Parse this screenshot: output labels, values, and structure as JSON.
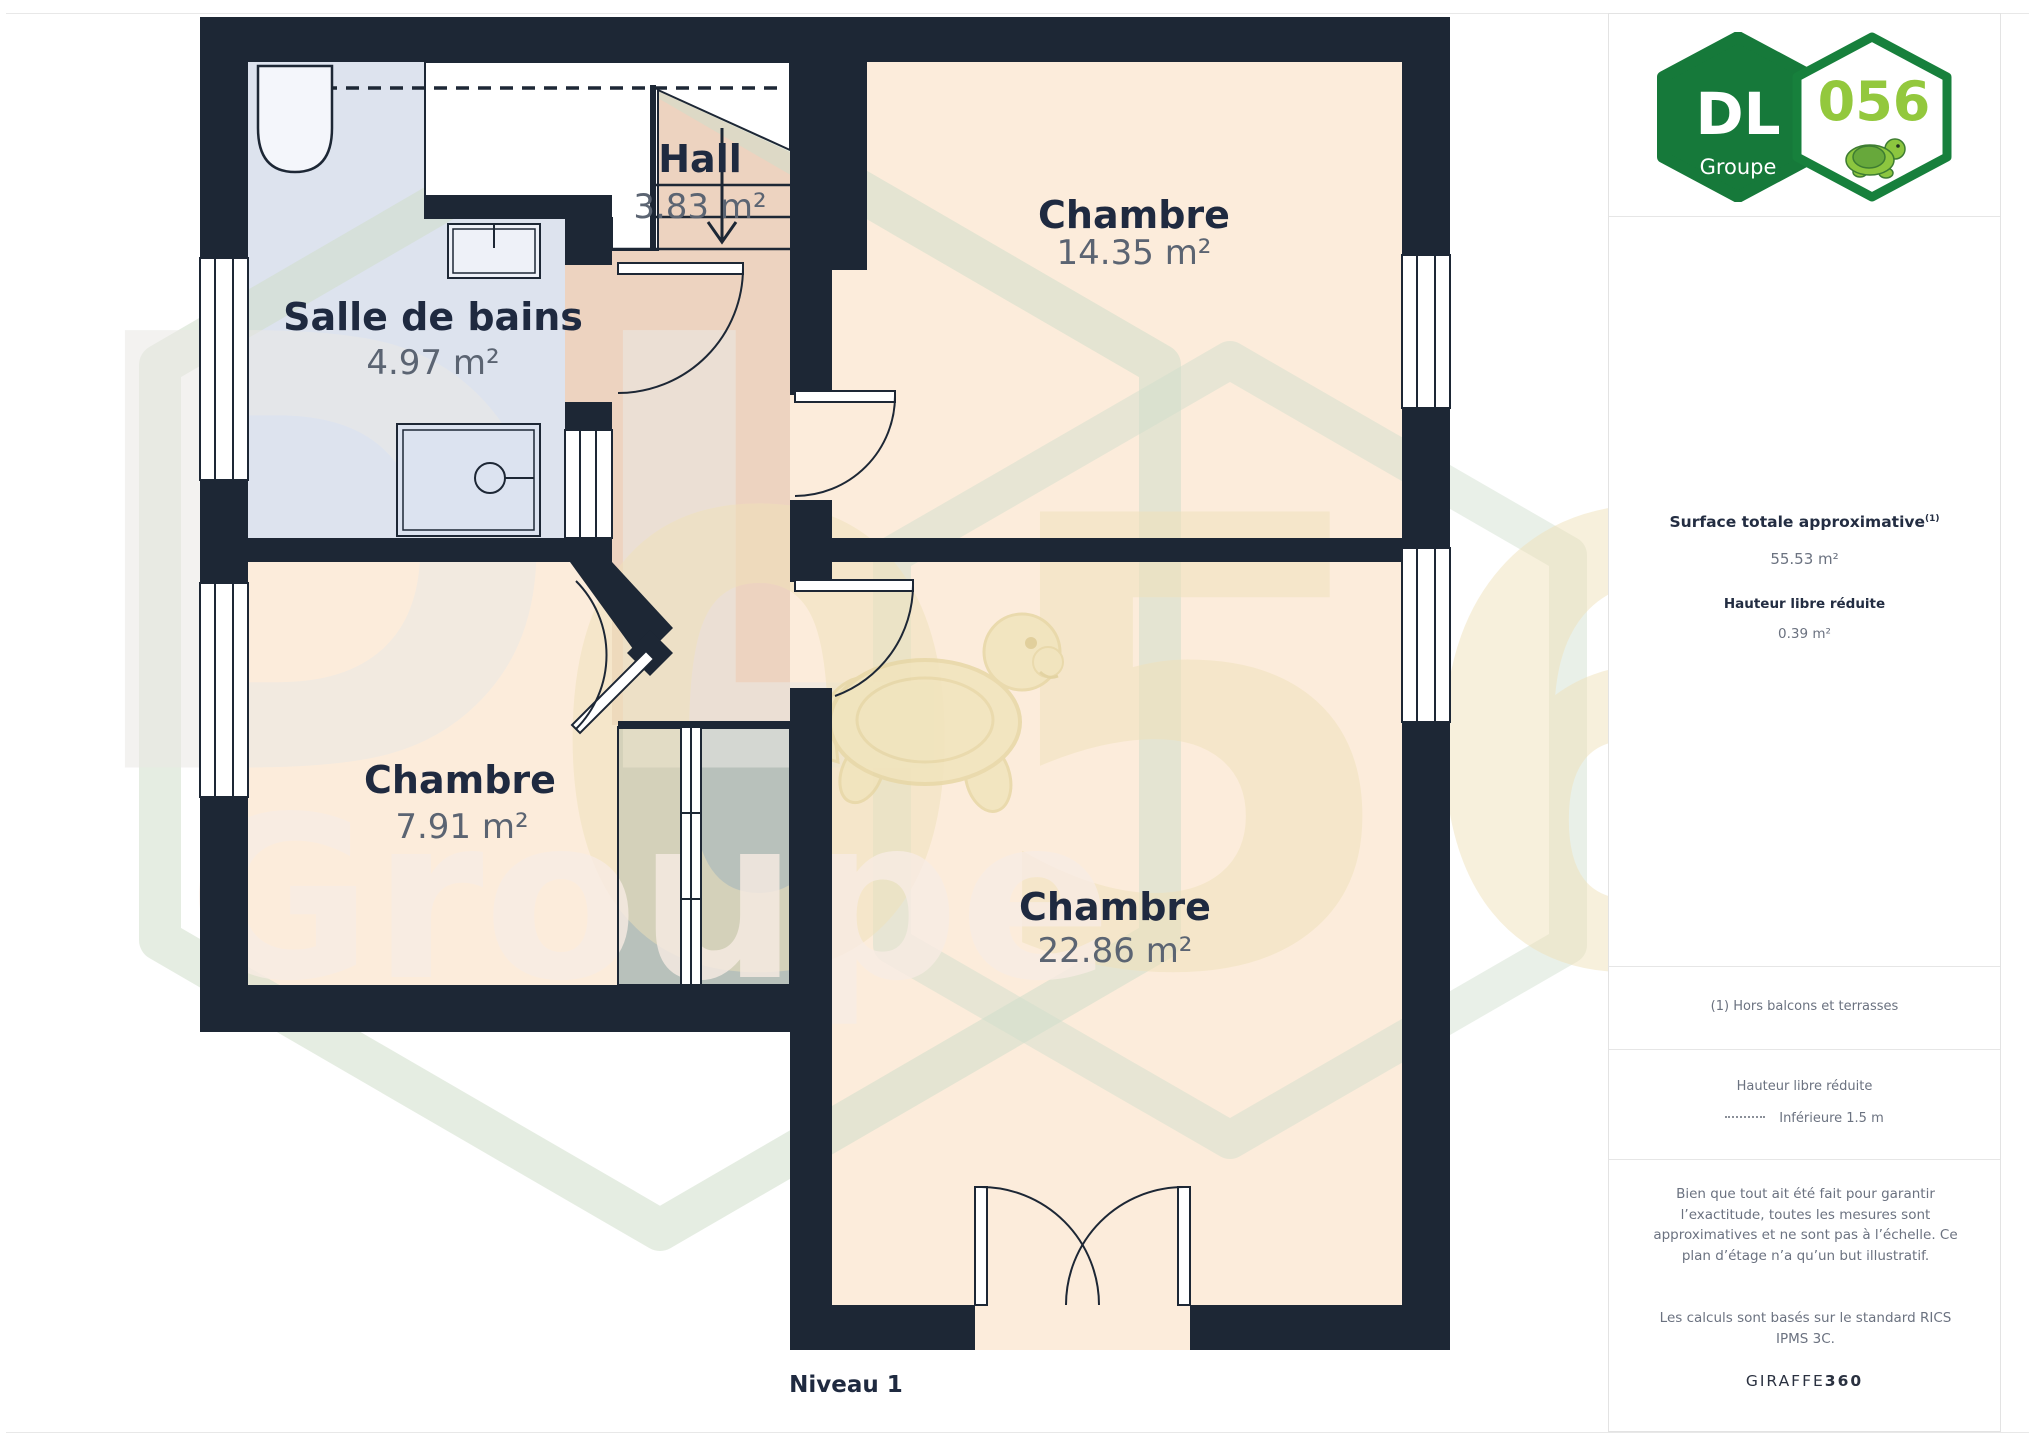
{
  "page": {
    "level_label": "Niveau 1"
  },
  "plan": {
    "rooms": [
      {
        "name": "Hall",
        "area": "3.83 m²"
      },
      {
        "name": "Salle de bains",
        "area": "4.97 m²"
      },
      {
        "name": "Chambre",
        "area": "14.35 m²"
      },
      {
        "name": "Chambre",
        "area": "7.91 m²"
      },
      {
        "name": "Chambre",
        "area": "22.86 m²"
      }
    ],
    "colors": {
      "wall": "#1d2735",
      "bedroom_floor": "#fcecdb",
      "hall_floor": "#edd3c0",
      "bathroom_floor": "#dde3ee",
      "glazed_zone": "#b8c1bb"
    }
  },
  "watermark": {
    "initials": "DL",
    "word": "Groupe",
    "code": "056"
  },
  "sidebar": {
    "logo": {
      "initials": "DL",
      "word": "Groupe",
      "code": "056"
    },
    "surface_title": "Surface totale approximative",
    "surface_footnote_marker": "(1)",
    "surface_value": "55.53 m²",
    "reduced_height_title": "Hauteur libre réduite",
    "reduced_height_value": "0.39 m²",
    "footnote": "(1) Hors balcons et terrasses",
    "legend_title": "Hauteur libre réduite",
    "legend_item": "Inférieure 1.5 m",
    "disclaimer": "Bien que tout ait été fait pour garantir l’exactitude, toutes les mesures sont approximatives et ne sont pas à l’échelle. Ce plan d’étage n’a qu’un but illustratif.",
    "standard_note": "Les calculs sont basés sur le standard RICS IPMS 3C.",
    "brand": "GIRAFFE",
    "brand_suffix": "360"
  }
}
